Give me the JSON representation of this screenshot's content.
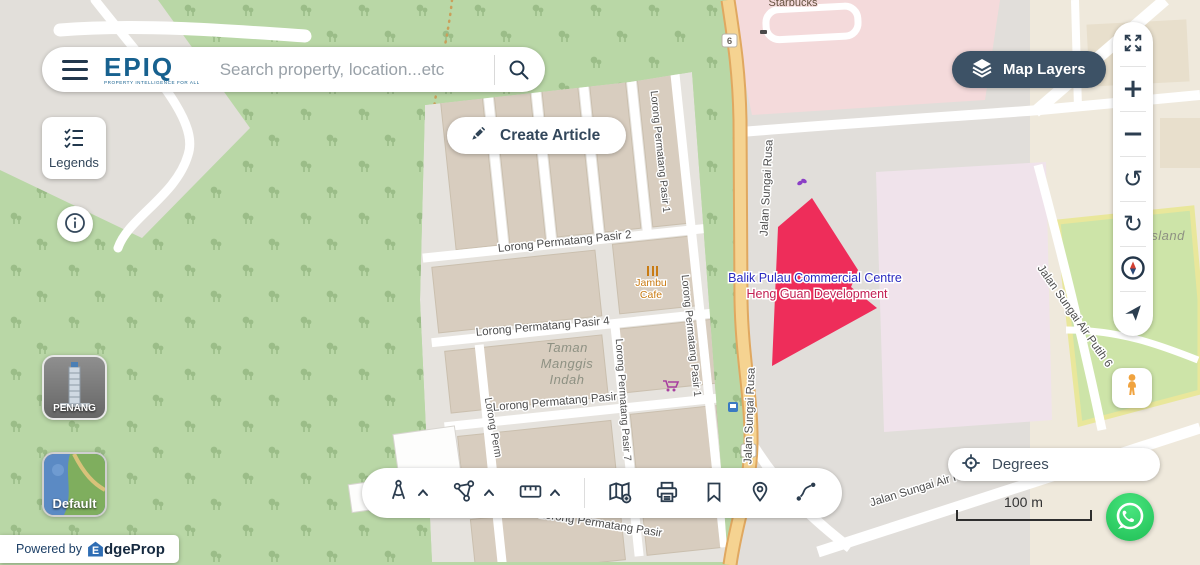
{
  "colors": {
    "accent_dark": "#33475b",
    "brand_blue": "#17618f",
    "map_layers_bg": "#3d5266",
    "parcel_red": "#ee2d5a",
    "whatsapp_green": "#25d366",
    "pegman_orange": "#f0a33f"
  },
  "header": {
    "logo": "EPIQ",
    "logo_tagline": "PROPERTY INTELLIGENCE FOR ALL",
    "search_placeholder": "Search property, location...etc",
    "create_article": "Create Article",
    "map_layers": "Map Layers"
  },
  "left": {
    "legends": "Legends",
    "city_thumb": "PENANG",
    "style_thumb": "Default",
    "powered_by": "Powered by",
    "brand_initial": "E",
    "brand_rest": "dgeProp"
  },
  "right_toolbar": {
    "zoom_in_glyph": "+",
    "zoom_out_glyph": "−",
    "rotate_ccw_glyph": "↺",
    "rotate_cw_glyph": "↻"
  },
  "tools": [
    "draw-compass",
    "polygon-draw",
    "ruler",
    "map-add",
    "print",
    "bookmark",
    "location-pin",
    "route"
  ],
  "bottom_right": {
    "degrees": "Degrees",
    "scale": "100 m"
  },
  "map": {
    "shield": "6",
    "labels": {
      "starbucks": "Starbucks",
      "jalan_sungai_rusa_top": "Jalan Sungai Rusa",
      "jalan_sungai_rusa_bottom": "Jalan Sungai Rusa",
      "lpp1_top": "Lorong Permatang Pasir 1",
      "lpp1_right": "Lorong Permatang Pasir 1",
      "lpp2": "Lorong Permatang Pasir 2",
      "lpp4": "Lorong Permatang Pasir 4",
      "lpp6": "Lorong Permatang Pasir 6",
      "lpp7": "Lorong Permatang Pasir 7",
      "lpp_left": "Lorong Perm",
      "lpp_bottom": "Lorong Permatang Pasir",
      "taman1": "Taman",
      "taman2": "Manggis",
      "taman3": "Indah",
      "jambu1": "Jambu",
      "jambu2": "Cafe",
      "poi_blue": "Balik Pulau Commercial Centre",
      "poi_red": "Heng Guan Development",
      "air_putih_6": "Jalan Sungai Air Putih 6",
      "air_putih_bottom": "Jalan Sungai Air Putih",
      "island": "Island"
    }
  }
}
